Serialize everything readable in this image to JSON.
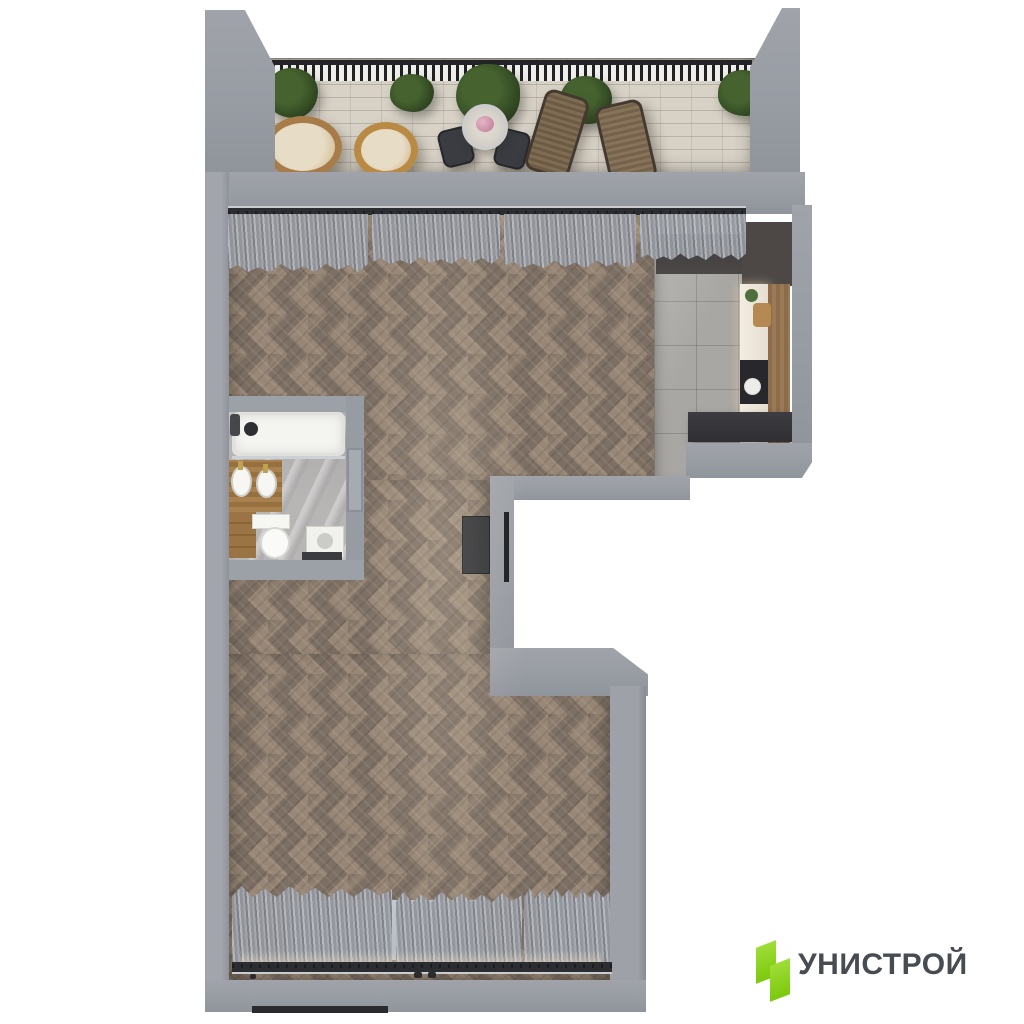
{
  "brand": {
    "name": "УНИСТРОЙ",
    "logo_green": "#8CD41E",
    "logo_text_color": "#474C52"
  },
  "scene": {
    "type": "3d-apartment-floor-plan-top-view",
    "rooms": [
      "terrace",
      "living-kitchen-area",
      "bathroom",
      "entrance",
      "bedroom-area"
    ],
    "colors": {
      "wall": "#9A9DA4",
      "wood_floor": "#8B7B6E",
      "terrace_tile": "#D7D1C6",
      "kitchen_tile": "#A9A7A3",
      "bathroom_marble": "#B8B6B5",
      "curtain": "#9B9EA5",
      "door_dark": "#2E3034"
    }
  }
}
